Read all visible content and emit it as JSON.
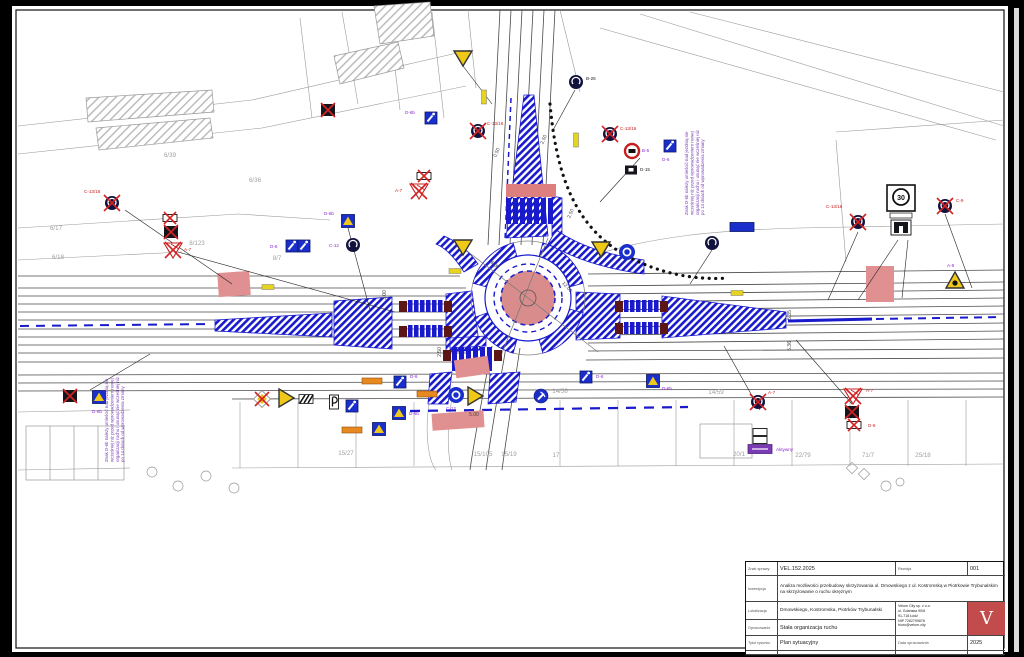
{
  "colors": {
    "marking_blue": "#1a1acd",
    "sign_blue": "#1a2ecb",
    "navy": "#12123e",
    "removed_red": "#c82020",
    "new_purple": "#8a2bd0",
    "island_pink": "#d98c8c",
    "crosswalk_pink": "#e09090",
    "sign_yellow": "#f0c818",
    "orange": "#e8891f",
    "logo_red": "#c24b4b"
  },
  "drawing": {
    "notes": [
      {
        "x": 688,
        "y": 215,
        "color": "#7a3bb5",
        "lines": [
          "Znak D-6b należy umieścić nad jezdnią nie",
          "wcześniej niż przed wprowadzeniem nowej",
          "organizacji ruchu i usunąć nie wcześniej niż",
          "po 14 dniach od wprowadzenia zmiany"
        ]
      },
      {
        "x": 108,
        "y": 462,
        "color": "#7a3bb5",
        "lines": [
          "Znak D-6b należy umieścić nad jezdnią nie",
          "wcześniej niż przed wprowadzeniem nowej",
          "organizacji ruchu i usunąć nie wcześniej niż",
          "po 14 dniach od wprowadzenia zmiany"
        ]
      }
    ],
    "dimensions": [
      {
        "text": "2.50",
        "x": 545,
        "y": 140,
        "rot": -68
      },
      {
        "text": "0.50",
        "x": 498,
        "y": 153,
        "rot": -68
      },
      {
        "text": "2.50",
        "x": 572,
        "y": 214,
        "rot": -68
      },
      {
        "text": "3.00",
        "x": 386,
        "y": 295,
        "rot": -90
      },
      {
        "text": "2.50",
        "x": 441,
        "y": 352,
        "rot": -90
      },
      {
        "text": "6.00",
        "x": 494,
        "y": 266,
        "rot": 38
      },
      {
        "text": "12.00",
        "x": 566,
        "y": 288,
        "rot": 48
      },
      {
        "text": "5.35",
        "x": 791,
        "y": 315,
        "rot": -90
      },
      {
        "text": "5.36",
        "x": 791,
        "y": 346,
        "rot": -90
      },
      {
        "text": "5.00",
        "x": 474,
        "y": 416,
        "rot": 0
      }
    ],
    "parcels": [
      {
        "text": "6/39",
        "x": 170,
        "y": 157
      },
      {
        "text": "6/36",
        "x": 255,
        "y": 182
      },
      {
        "text": "6/17",
        "x": 56,
        "y": 230
      },
      {
        "text": "6/18",
        "x": 58,
        "y": 259
      },
      {
        "text": "8/123",
        "x": 197,
        "y": 245
      },
      {
        "text": "8/7",
        "x": 277,
        "y": 260
      },
      {
        "text": "15/27",
        "x": 346,
        "y": 455
      },
      {
        "text": "15/105",
        "x": 483,
        "y": 456
      },
      {
        "text": "15/19",
        "x": 509,
        "y": 456
      },
      {
        "text": "17",
        "x": 556,
        "y": 457
      },
      {
        "text": "14/56",
        "x": 560,
        "y": 393
      },
      {
        "text": "14/59",
        "x": 716,
        "y": 394
      },
      {
        "text": "20/1",
        "x": 739,
        "y": 456
      },
      {
        "text": "22/79",
        "x": 803,
        "y": 457
      },
      {
        "text": "71/7",
        "x": 868,
        "y": 457
      },
      {
        "text": "25/18",
        "x": 923,
        "y": 457
      }
    ],
    "signs": [
      {
        "t": "circle-removed",
        "x": 112,
        "y": 203,
        "l": "C-13/16",
        "lc": "r",
        "dx": -28,
        "dy": -10
      },
      {
        "t": "plate-removed",
        "x": 170,
        "y": 218
      },
      {
        "t": "black-plate-removed",
        "x": 171,
        "y": 232
      },
      {
        "t": "tri-removed",
        "x": 173,
        "y": 250,
        "l": "A-7",
        "lc": "r",
        "dx": 11,
        "dy": 1
      },
      {
        "t": "black-plate-removed",
        "x": 328,
        "y": 110
      },
      {
        "t": "ybar",
        "x": 268,
        "y": 287
      },
      {
        "t": "bluesq-tri",
        "x": 348,
        "y": 221,
        "l": "D-6b",
        "lc": "p",
        "dx": -24,
        "dy": -6
      },
      {
        "t": "navy",
        "x": 353,
        "y": 245,
        "l": "C-12",
        "lc": "p",
        "dx": -24,
        "dy": 2
      },
      {
        "t": "bluesq",
        "x": 292,
        "y": 246,
        "l": "D-6",
        "lc": "p",
        "dx": -22,
        "dy": 2
      },
      {
        "t": "bluesq",
        "x": 304,
        "y": 246
      },
      {
        "t": "plate-removed",
        "x": 424,
        "y": 176
      },
      {
        "t": "tri-removed",
        "x": 419,
        "y": 191,
        "l": "A-7",
        "lc": "r",
        "dx": -24,
        "dy": 1
      },
      {
        "t": "bluesq",
        "x": 431,
        "y": 118,
        "l": "D-6b",
        "lc": "p",
        "dx": -26,
        "dy": -4
      },
      {
        "t": "ybar-v",
        "x": 484,
        "y": 97
      },
      {
        "t": "ybar-v",
        "x": 576,
        "y": 140
      },
      {
        "t": "circle-removed",
        "x": 478,
        "y": 131,
        "l": "C-13/16",
        "lc": "r",
        "dx": 9,
        "dy": -6
      },
      {
        "t": "yield",
        "x": 463,
        "y": 58
      },
      {
        "t": "navy",
        "x": 576,
        "y": 82,
        "l": "B-26",
        "lc": "k",
        "dx": 10,
        "dy": -2
      },
      {
        "t": "circle-removed",
        "x": 610,
        "y": 134,
        "l": "C-13/16",
        "lc": "r",
        "dx": 10,
        "dy": -4
      },
      {
        "t": "red-circle",
        "x": 632,
        "y": 151,
        "l": "B-5",
        "lc": "p",
        "dx": 10,
        "dy": 1
      },
      {
        "t": "black-plate",
        "x": 631,
        "y": 170,
        "l": "D-15",
        "lc": "k",
        "dx": 9,
        "dy": 1
      },
      {
        "t": "bluesq",
        "x": 670,
        "y": 146,
        "l": "D-6",
        "lc": "p",
        "dx": -8,
        "dy": 15
      },
      {
        "t": "yield",
        "x": 463,
        "y": 247
      },
      {
        "t": "yield",
        "x": 601,
        "y": 249
      },
      {
        "t": "c12",
        "x": 627,
        "y": 252
      },
      {
        "t": "navy",
        "x": 712,
        "y": 243
      },
      {
        "t": "blue-rect",
        "x": 742,
        "y": 227
      },
      {
        "t": "circle-removed",
        "x": 858,
        "y": 222,
        "l": "C-13/16",
        "lc": "r",
        "dx": -32,
        "dy": -14
      },
      {
        "t": "circle-removed",
        "x": 945,
        "y": 206,
        "l": "C-9",
        "lc": "r",
        "dx": 11,
        "dy": -4
      },
      {
        "t": "zone30",
        "x": 901,
        "y": 198,
        "glyph": "30"
      },
      {
        "t": "warn-dot",
        "x": 955,
        "y": 281,
        "l": "A-8",
        "lc": "p",
        "dx": -8,
        "dy": -14
      },
      {
        "t": "black-plate-removed",
        "x": 70,
        "y": 396
      },
      {
        "t": "bluesq-tri",
        "x": 99,
        "y": 397,
        "l": "D-6b",
        "lc": "p",
        "dx": -7,
        "dy": 16
      },
      {
        "t": "diamond-removed",
        "x": 262,
        "y": 399
      },
      {
        "t": "yield",
        "x": 286,
        "y": 398,
        "r": -90
      },
      {
        "t": "striped",
        "x": 306,
        "y": 399
      },
      {
        "t": "p-plate",
        "x": 334,
        "y": 402
      },
      {
        "t": "bluesq",
        "x": 352,
        "y": 406
      },
      {
        "t": "orange-bar",
        "x": 372,
        "y": 381
      },
      {
        "t": "orange-bar",
        "x": 427,
        "y": 394
      },
      {
        "t": "orange-bar",
        "x": 352,
        "y": 430
      },
      {
        "t": "bluesq",
        "x": 400,
        "y": 382,
        "l": "D-6",
        "lc": "p",
        "dx": 10,
        "dy": -4
      },
      {
        "t": "bluesq-tri",
        "x": 399,
        "y": 413,
        "l": "D-6b",
        "lc": "p",
        "dx": 10,
        "dy": 2
      },
      {
        "t": "bluesq-tri",
        "x": 379,
        "y": 429
      },
      {
        "t": "c12",
        "x": 456,
        "y": 395,
        "l": "C-12",
        "lc": "p",
        "dx": -10,
        "dy": 15
      },
      {
        "t": "yield",
        "x": 475,
        "y": 396,
        "r": -90
      },
      {
        "t": "c9",
        "x": 541,
        "y": 396
      },
      {
        "t": "bluesq",
        "x": 586,
        "y": 377,
        "l": "D-6",
        "lc": "p",
        "dx": 10,
        "dy": 1
      },
      {
        "t": "bluesq-tri",
        "x": 653,
        "y": 381,
        "l": "D-6b",
        "lc": "p",
        "dx": 9,
        "dy": 9
      },
      {
        "t": "circle-removed",
        "x": 758,
        "y": 402,
        "l": "A-7",
        "lc": "r",
        "dx": 10,
        "dy": -8
      },
      {
        "t": "tri-removed",
        "x": 853,
        "y": 396,
        "l": "A-7",
        "lc": "r",
        "dx": 13,
        "dy": -4
      },
      {
        "t": "black-plate-removed",
        "x": 852,
        "y": 412
      },
      {
        "t": "plate-removed",
        "x": 854,
        "y": 425,
        "l": "D-6",
        "lc": "r",
        "dx": 14,
        "dy": 2
      },
      {
        "t": "plate",
        "x": 760,
        "y": 432
      },
      {
        "t": "plate",
        "x": 760,
        "y": 440
      },
      {
        "t": "purple-rect",
        "x": 760,
        "y": 449,
        "l": "Aktywny",
        "lc": "p",
        "dx": 16,
        "dy": 2
      },
      {
        "t": "ybar",
        "x": 455,
        "y": 271
      },
      {
        "t": "ybar",
        "x": 737,
        "y": 293
      }
    ]
  },
  "titleblock": {
    "rows": {
      "znak_sprawy_label": "Znak sprawy",
      "znak_sprawy": "VEL.152.2025",
      "rewizja_label": "Rewizja",
      "rewizja": "001",
      "inwestycja_label": "Inwestycja",
      "inwestycja": "Analiza możliwości przebudowy skrzyżowania ul. Dmowskiego z ul. Kostromską w Piotrkowie Trybunalskim na skrzyżowanie o ruchu okrężnym",
      "lokalizacja_label": "Lokalizacja",
      "lokalizacja": "Dmowskiego, Kostromska, Piotrków Trybunalski",
      "opracowanie_label": "Opracowanie",
      "opracowanie": "Stała organizacja ruchu",
      "tytul_label": "Tytuł rysunku",
      "tytul": "Plan sytuacyjny",
      "data_label": "Data opracowania",
      "data": "2025"
    },
    "company": {
      "lines": [
        "Velum City sp. z o.o.",
        "ul. Gdańska 90/8",
        "91-718 Łódź",
        "NIP 7262799878",
        "biuro@velum.city"
      ]
    },
    "logo_letter": "V"
  }
}
